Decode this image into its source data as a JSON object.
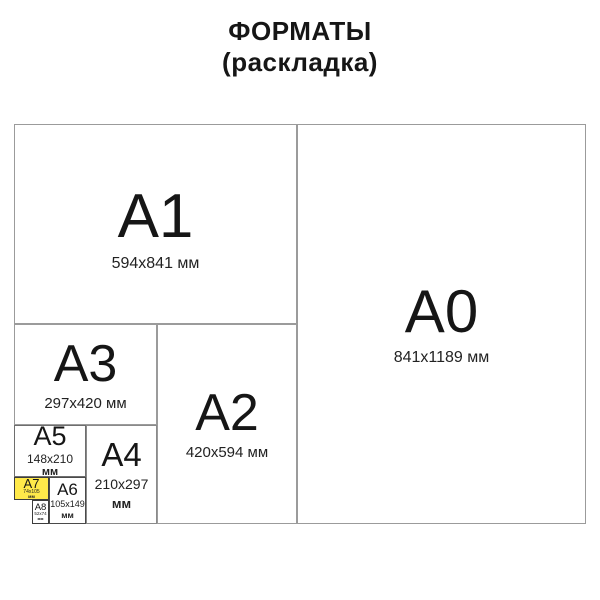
{
  "title": {
    "line1": "ФОРМАТЫ",
    "line2": "(раскладка)"
  },
  "colors": {
    "highlight_yellow": "#ffe94a",
    "grid_line": "#9b9b9b",
    "text": "#1c1c1c",
    "background": "#ffffff"
  },
  "diagram": {
    "formats": {
      "a0": {
        "label": "A0",
        "dims": "841x1189 мм",
        "highlighted": false
      },
      "a1": {
        "label": "A1",
        "dims": "594x841 мм",
        "highlighted": false
      },
      "a2": {
        "label": "A2",
        "dims": "420x594 мм",
        "highlighted": false
      },
      "a3": {
        "label": "A3",
        "dims": "297x420 мм",
        "highlighted": false
      },
      "a4": {
        "label": "A4",
        "dims1": "210x297",
        "dims2": "мм",
        "highlighted": false
      },
      "a5": {
        "label": "A5",
        "dims1": "148x210",
        "dims2": "мм",
        "highlighted": false
      },
      "a6": {
        "label": "A6",
        "dims1": "105x149",
        "dims2": "мм",
        "highlighted": false
      },
      "a7": {
        "label": "A7",
        "dims1": "74x105",
        "dims2": "мм",
        "highlighted": true
      },
      "a8": {
        "label": "A8",
        "dims1": "52x74",
        "dims2": "мм",
        "highlighted": false
      }
    }
  }
}
